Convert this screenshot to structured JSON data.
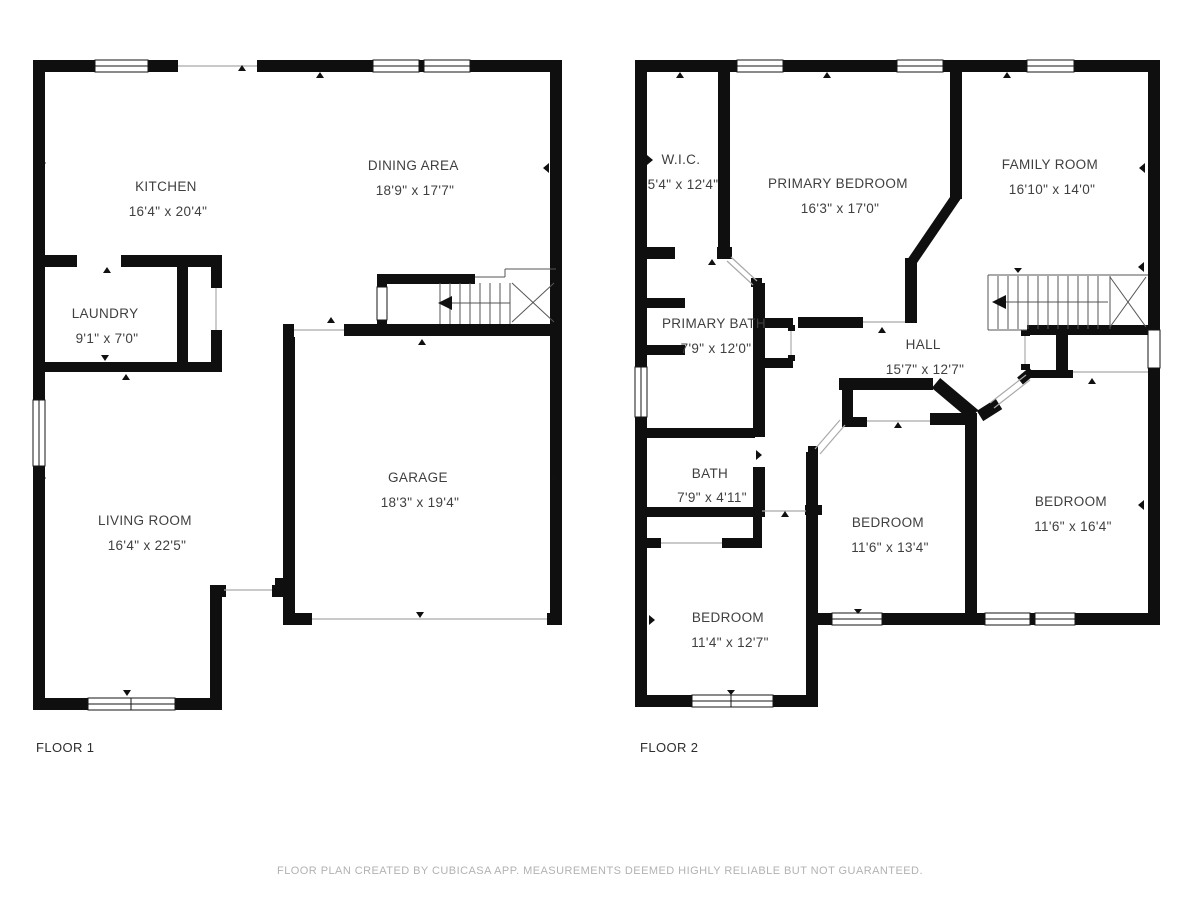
{
  "colors": {
    "wall": "#0f0f0f",
    "room_text": "#3f3f3f",
    "floor_label_text": "#2e2e2e",
    "footer_text": "#b2b2b2",
    "background": "#ffffff"
  },
  "floors": [
    {
      "label": "FLOOR 1",
      "rooms": [
        {
          "name": "KITCHEN",
          "size": "16'4\" x 20'4\""
        },
        {
          "name": "DINING AREA",
          "size": "18'9\" x 17'7\""
        },
        {
          "name": "LAUNDRY",
          "size": "9'1\" x 7'0\""
        },
        {
          "name": "GARAGE",
          "size": "18'3\" x 19'4\""
        },
        {
          "name": "LIVING ROOM",
          "size": "16'4\" x 22'5\""
        }
      ]
    },
    {
      "label": "FLOOR 2",
      "rooms": [
        {
          "name": "W.I.C.",
          "size": "5'4\" x 12'4\""
        },
        {
          "name": "PRIMARY BEDROOM",
          "size": "16'3\" x 17'0\""
        },
        {
          "name": "FAMILY ROOM",
          "size": "16'10\" x 14'0\""
        },
        {
          "name": "PRIMARY BATH",
          "size": "7'9\" x 12'0\""
        },
        {
          "name": "HALL",
          "size": "15'7\" x 12'7\""
        },
        {
          "name": "BATH",
          "size": "7'9\" x 4'11\""
        },
        {
          "name": "BEDROOM",
          "size": "11'4\" x 12'7\""
        },
        {
          "name": "BEDROOM",
          "size": "11'6\" x 13'4\""
        },
        {
          "name": "BEDROOM",
          "size": "11'6\" x 16'4\""
        }
      ]
    }
  ],
  "footer": {
    "disclaimer": "FLOOR PLAN CREATED BY CUBICASA APP. MEASUREMENTS DEEMED HIGHLY RELIABLE BUT NOT GUARANTEED."
  }
}
